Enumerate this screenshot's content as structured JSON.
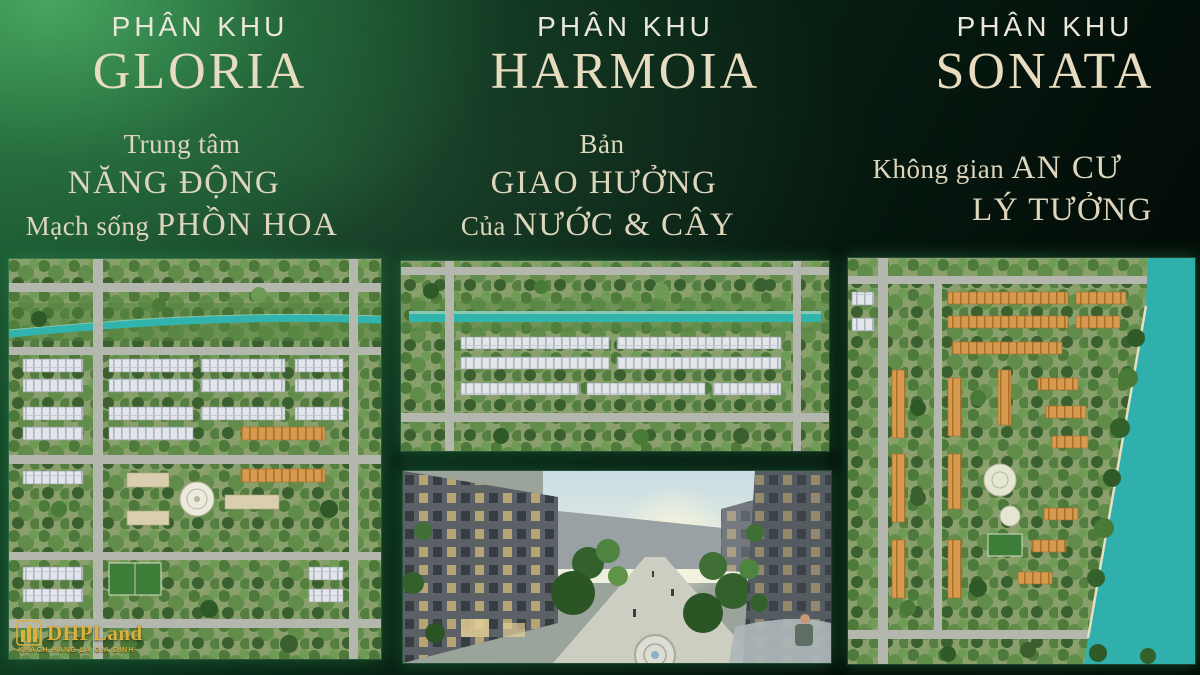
{
  "page": {
    "background_base": "#040f09",
    "background_glow": "#2f8a4c",
    "text_cream": "#e7dcc0",
    "text_label": "#ebe7d9",
    "water_teal": "#2fb0ad",
    "roof_orange": "#d89a4f",
    "logo_gold": "#d9b13c"
  },
  "sections": [
    {
      "id": "gloria",
      "label": "PHÂN KHU",
      "name": "GLORIA",
      "tagline_rows": [
        {
          "pre": "Trung tâm",
          "caps": "",
          "dx": 0
        },
        {
          "pre": "",
          "caps": "NĂNG ĐỘNG",
          "dx": -8
        },
        {
          "pre": "Mạch sống ",
          "caps": "PHỒN HOA",
          "dx": 0
        }
      ],
      "image": "aerial-master-plan"
    },
    {
      "id": "harmoia",
      "label": "PHÂN KHU",
      "name": "HARMOIA",
      "tagline_rows": [
        {
          "pre": "Bản",
          "caps": "",
          "dx": -18
        },
        {
          "pre": "",
          "caps": "GIAO HƯỞNG",
          "dx": -16
        },
        {
          "pre": "Của ",
          "caps": "NƯỚC & CÂY",
          "dx": -22
        }
      ],
      "image": "aerial-master-plan-and-street-view"
    },
    {
      "id": "sonata",
      "label": "PHÂN KHU",
      "name": "SONATA",
      "tagline_rows": [
        {
          "pre": "Không gian ",
          "caps": "AN CƯ",
          "dx": -25
        },
        {
          "pre": "",
          "caps": "LÝ TƯỞNG",
          "dx": 40
        }
      ],
      "image": "aerial-master-plan-riverside"
    }
  ],
  "logo": {
    "brand": "DHPLand",
    "slogan": "KHÁCH HÀNG LÀ GIA ĐÌNH"
  }
}
